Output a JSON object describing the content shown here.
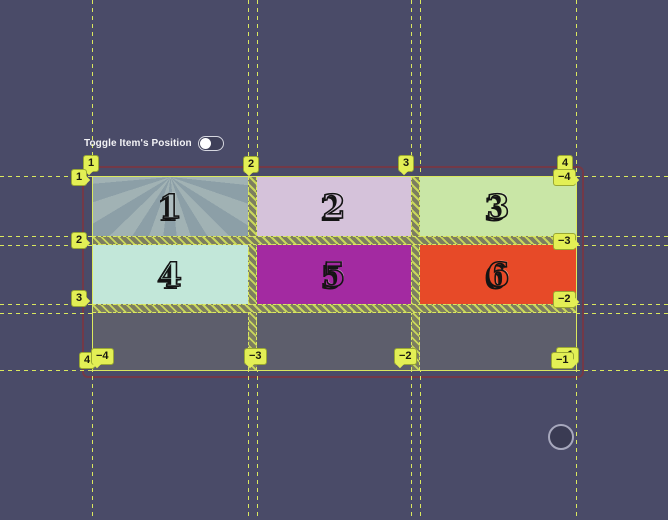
{
  "app": {
    "background_color": "#4a4b68",
    "overlay_line_color": "#dbe95e",
    "badge_color": "#e3ef55",
    "container_outline_color": "#7a3642",
    "empty_cell_color": "#5d5e6c",
    "gap_hatch_colors": [
      "#7d7e60",
      "#c9d75c"
    ]
  },
  "controls": {
    "toggle_label": "Toggle Item's Position",
    "toggle_state": "off"
  },
  "grid_overlay": {
    "badges_top": [
      "1",
      "2",
      "3",
      "4"
    ],
    "badges_left": [
      "1",
      "2",
      "3",
      "4"
    ],
    "badges_right": [
      "−4",
      "−3",
      "−2",
      "−1"
    ],
    "badges_bottom": [
      "−4",
      "−3",
      "−2",
      "−1"
    ]
  },
  "grid_items": [
    {
      "label": "1",
      "color": "#8c9fa7",
      "pattern": "sunburst"
    },
    {
      "label": "2",
      "color": "#d5c2da"
    },
    {
      "label": "3",
      "color": "#c9e6a6"
    },
    {
      "label": "4",
      "color": "#c2e7d9"
    },
    {
      "label": "5",
      "color": "#a32aa1"
    },
    {
      "label": "6",
      "color": "#e74a28"
    }
  ]
}
